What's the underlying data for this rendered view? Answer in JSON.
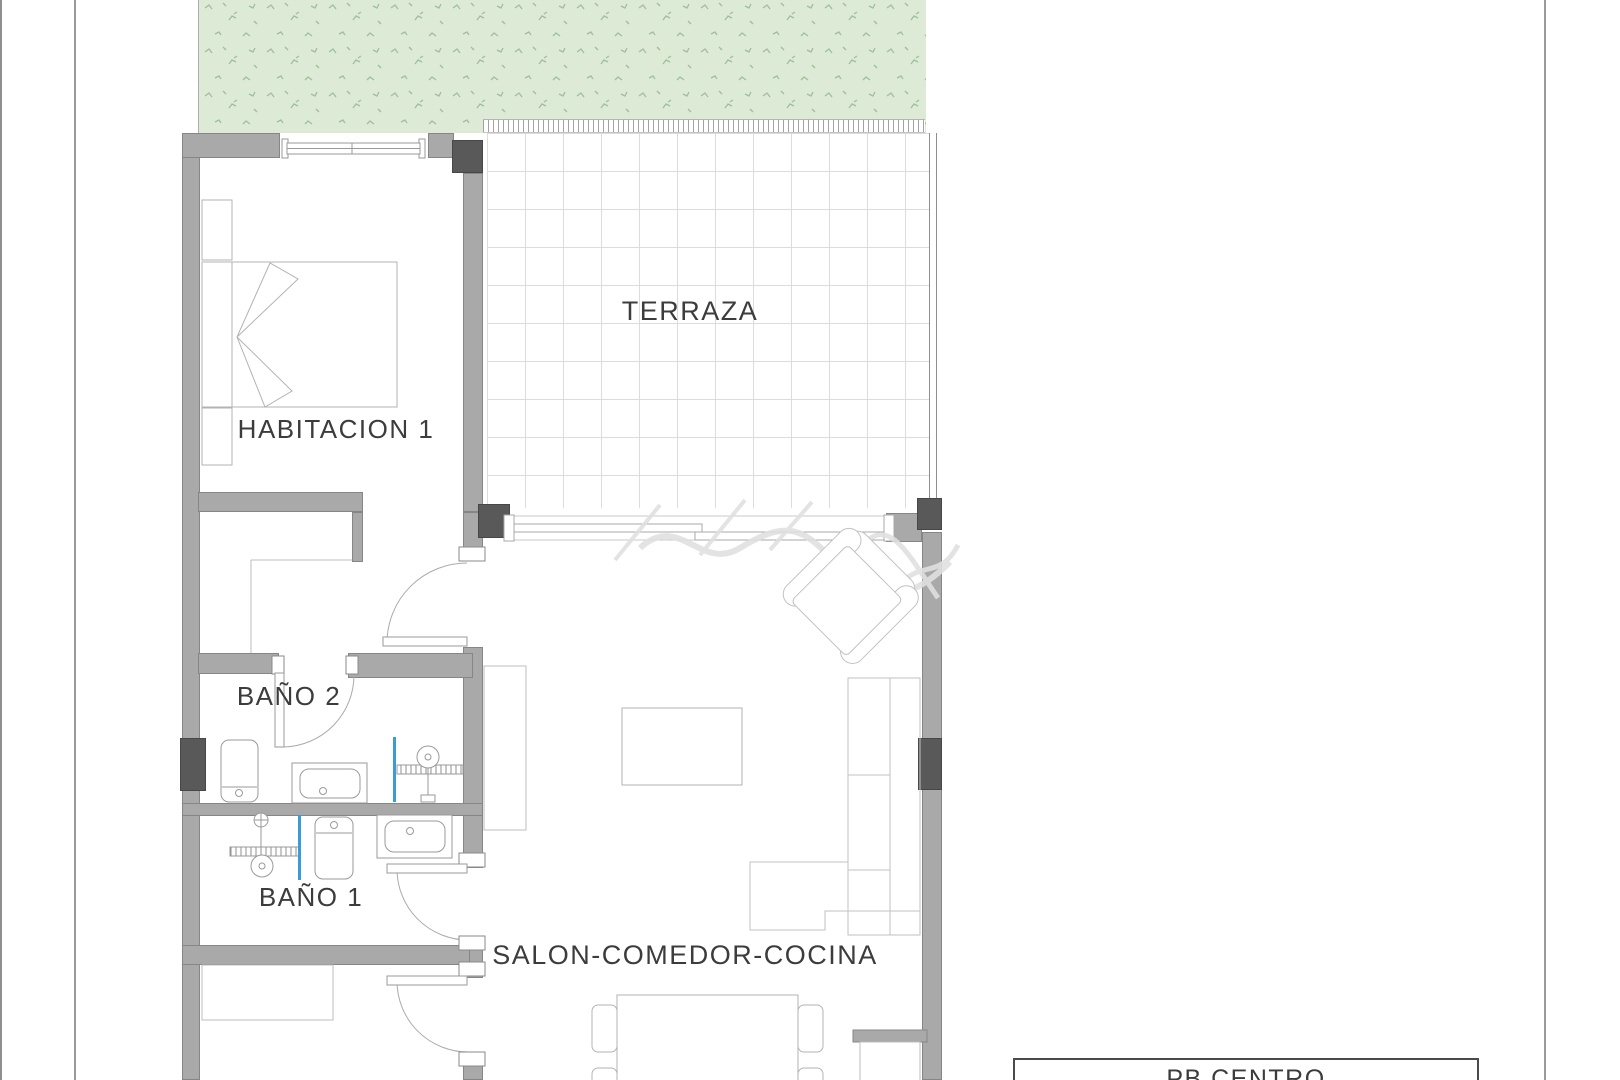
{
  "plan": {
    "type": "architectural-floor-plan",
    "title_block": {
      "label": "PB CENTRO"
    },
    "rooms": [
      {
        "id": "terraza",
        "label": "TERRAZA"
      },
      {
        "id": "habitacion1",
        "label": "HABITACION 1"
      },
      {
        "id": "bano2",
        "label": "BAÑO 2"
      },
      {
        "id": "bano1",
        "label": "BAÑO 1"
      },
      {
        "id": "salon",
        "label": "SALON-COMEDOR-COCINA"
      }
    ],
    "colors": {
      "wall": "#a9a9a9",
      "wall_dark": "#595959",
      "garden_fill": "#dcead6",
      "garden_speckle": "#9fbf9a",
      "tile_line": "#dcdcdc",
      "furniture_line": "#bcbcbc",
      "glass_screen_blue": "#3a9bd5",
      "text": "#3c3c3c",
      "sheet_line": "#9a9a9a"
    },
    "icons": [
      "grass-texture-icon",
      "window-icon",
      "sliding-door-icon",
      "door-arc-icon",
      "bed-icon",
      "nightstand-icon",
      "wardrobe-icon",
      "armchair-icon",
      "sofa-icon",
      "coffee-table-icon",
      "dining-table-icon",
      "chair-icon",
      "kitchen-counter-icon",
      "toilet-icon",
      "sink-icon",
      "shower-icon",
      "shower-screen-icon",
      "watermark-script-icon"
    ],
    "watermark": {
      "legible": false
    }
  }
}
